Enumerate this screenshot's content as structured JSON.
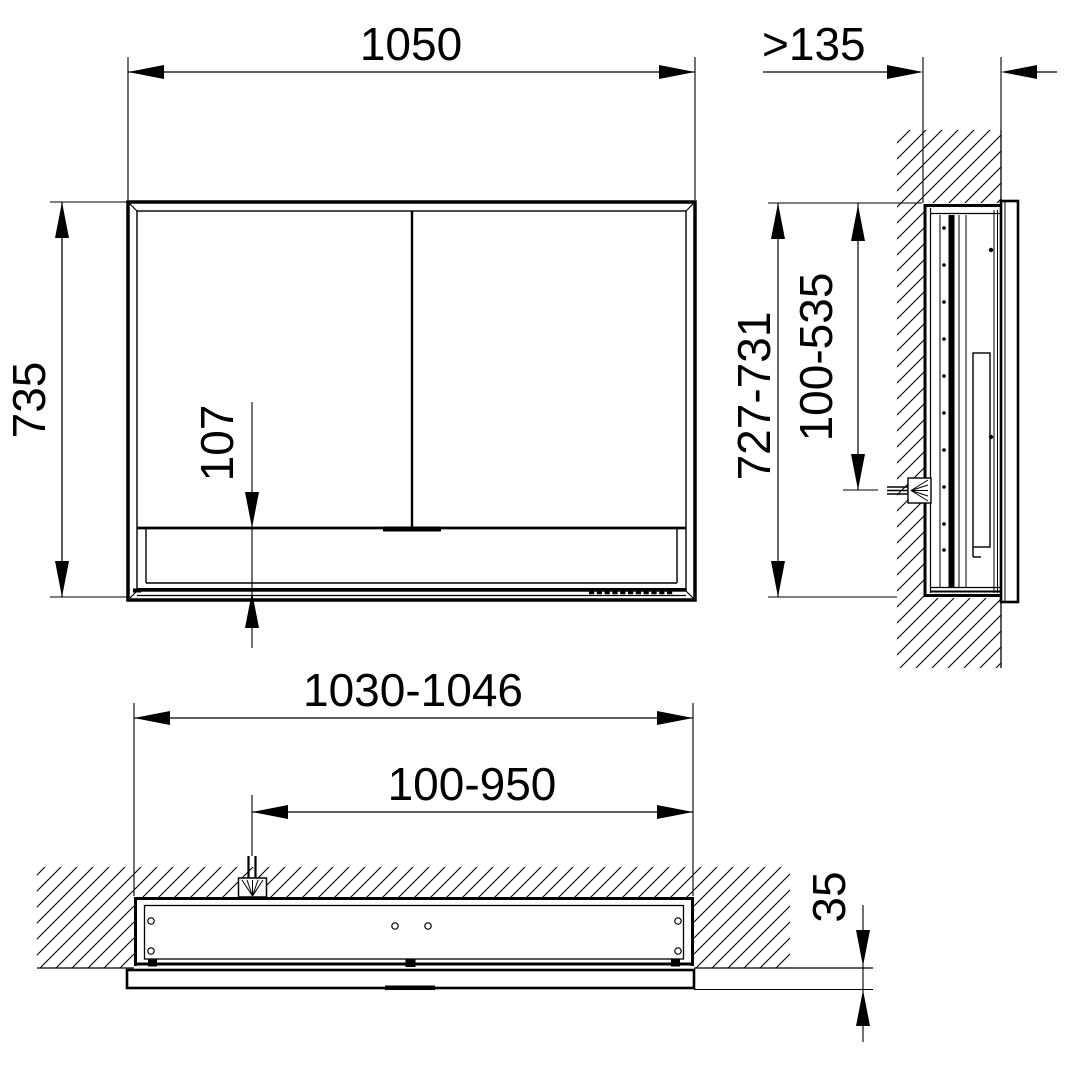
{
  "drawing": {
    "title": "Recessed mirror cabinet installation drawing",
    "unit": "mm",
    "line_color": "#000000",
    "background": "#ffffff",
    "views": {
      "front": {
        "label": "front-view",
        "dimensions": {
          "overall_width": "1050",
          "overall_height": "735",
          "lower_panel_height": "107"
        }
      },
      "side": {
        "label": "side-section-view",
        "dimensions": {
          "niche_depth_min": ">135",
          "niche_height_range": "727-731",
          "cable_outlet_height_range": "100-535"
        }
      },
      "plan": {
        "label": "top-section-view",
        "dimensions": {
          "niche_width_range": "1030-1046",
          "cable_outlet_lateral_range": "100-950",
          "front_protrusion": "35"
        }
      }
    }
  }
}
